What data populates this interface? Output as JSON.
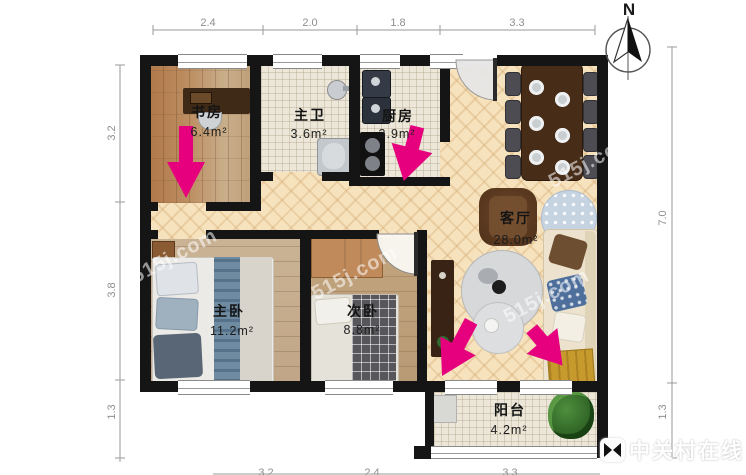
{
  "title": "apartment-floorplan",
  "compass": {
    "north_label": "N"
  },
  "rooms": [
    {
      "id": "study",
      "name": "书房",
      "area": "6.4m²"
    },
    {
      "id": "master-bath",
      "name": "主卫",
      "area": "3.6m²"
    },
    {
      "id": "kitchen",
      "name": "厨房",
      "area": "3.9m²"
    },
    {
      "id": "living-room",
      "name": "客厅",
      "area": "28.0m²"
    },
    {
      "id": "master-bedroom",
      "name": "主卧",
      "area": "11.2m²"
    },
    {
      "id": "second-bedroom",
      "name": "次卧",
      "area": "8.8m²"
    },
    {
      "id": "balcony",
      "name": "阳台",
      "area": "4.2m²"
    }
  ],
  "dimensions": {
    "top": [
      "2.4",
      "2.0",
      "1.8",
      "3.3"
    ],
    "left": [
      "3.2",
      "3.8",
      "1.3"
    ],
    "right": [
      "7.0",
      "1.3"
    ],
    "bottom": [
      "3.2",
      "2.4",
      "3.3"
    ]
  },
  "watermark": {
    "brand_text": "中关村在线",
    "diagonal_text": "515j.com"
  },
  "colors": {
    "arrow_accent": "#e6007e",
    "wall": "#151515",
    "dim_text": "#8f8f8f"
  },
  "icons": {
    "compass": "north-arrow-icon",
    "brand_logo": "zol-bowtie-logo"
  }
}
